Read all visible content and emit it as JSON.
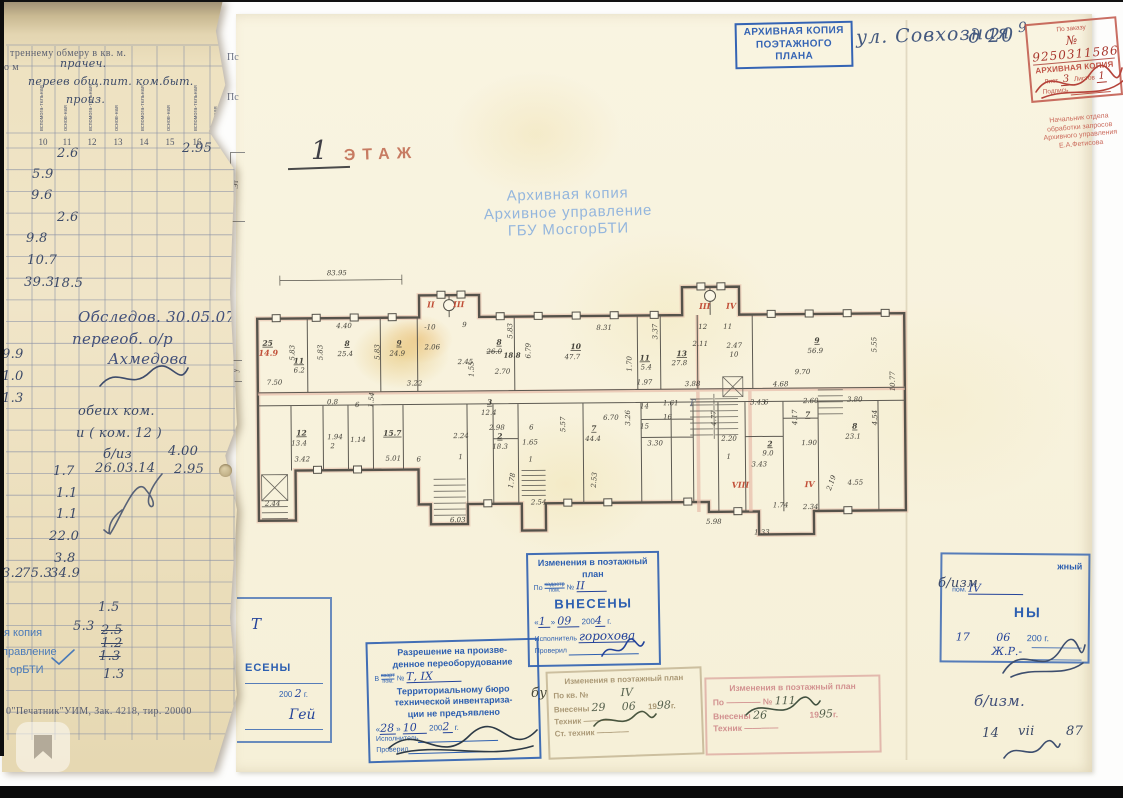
{
  "left_strip": {
    "header": "треннему обмеру в кв. м.",
    "header_left": "о м",
    "hand_over_header": [
      {
        "t": "прачеч.",
        "x": 58,
        "y": 57
      },
      {
        "t": "переев общ.пит. ком.быт.",
        "x": 26,
        "y": 75
      },
      {
        "t": "произ.",
        "x": 64,
        "y": 93
      }
    ],
    "col_headers": [
      {
        "t": "вспомога-тельная",
        "x": 41
      },
      {
        "t": "основ-ная",
        "x": 65
      },
      {
        "t": "вспомога-тельная",
        "x": 90
      },
      {
        "t": "основ-ная",
        "x": 116
      },
      {
        "t": "вспомога-тельная",
        "x": 142
      },
      {
        "t": "основ-ная",
        "x": 168
      },
      {
        "t": "вспомога-тельная",
        "x": 195
      },
      {
        "t": "Полезная",
        "x": 215
      },
      {
        "t": "Высота",
        "x": 226
      }
    ],
    "col_numbers": [
      {
        "t": "10",
        "x": 41
      },
      {
        "t": "11",
        "x": 65
      },
      {
        "t": "12",
        "x": 90
      },
      {
        "t": "13",
        "x": 116
      },
      {
        "t": "14",
        "x": 142
      },
      {
        "t": "15",
        "x": 168
      },
      {
        "t": "16",
        "x": 195
      },
      {
        "t": "17",
        "x": 220
      }
    ],
    "values": [
      {
        "t": "2.6",
        "x": 55,
        "y": 146
      },
      {
        "t": "2.95",
        "x": 180,
        "y": 141
      },
      {
        "t": "5.9",
        "x": 30,
        "y": 167
      },
      {
        "t": "9.6",
        "x": 29,
        "y": 188
      },
      {
        "t": "2.6",
        "x": 55,
        "y": 210
      },
      {
        "t": "9.8",
        "x": 24,
        "y": 231
      },
      {
        "t": "10.7",
        "x": 25,
        "y": 253
      },
      {
        "t": "39.3",
        "x": 22,
        "y": 275
      },
      {
        "t": "18.5",
        "x": 51,
        "y": 276
      },
      {
        "t": "9.9",
        "x": 0,
        "y": 347
      },
      {
        "t": "1.0",
        "x": 0,
        "y": 369
      },
      {
        "t": "1.3",
        "x": 0,
        "y": 391
      },
      {
        "t": "Обследов. 30.05.07",
        "x": 76,
        "y": 308,
        "c": "lg"
      },
      {
        "t": "перееоб. о/р",
        "x": 70,
        "y": 330,
        "c": "lg"
      },
      {
        "t": "Ахмедова",
        "x": 106,
        "y": 350,
        "c": "lg"
      },
      {
        "t": "обеих ком.",
        "x": 76,
        "y": 404
      },
      {
        "t": "и ( ком. 12 )",
        "x": 74,
        "y": 426
      },
      {
        "t": "б/из",
        "x": 101,
        "y": 447
      },
      {
        "t": "4.00",
        "x": 166,
        "y": 444
      },
      {
        "t": "1.7",
        "x": 51,
        "y": 464
      },
      {
        "t": "26.03.14",
        "x": 93,
        "y": 461
      },
      {
        "t": "2.95",
        "x": 172,
        "y": 462
      },
      {
        "t": "1.1",
        "x": 54,
        "y": 486
      },
      {
        "t": "1.1",
        "x": 54,
        "y": 507
      },
      {
        "t": "22.0",
        "x": 47,
        "y": 529
      },
      {
        "t": "3.8",
        "x": 52,
        "y": 551
      },
      {
        "t": "3.2",
        "x": 0,
        "y": 566
      },
      {
        "t": "75.3",
        "x": 20,
        "y": 566
      },
      {
        "t": "34.9",
        "x": 48,
        "y": 566
      },
      {
        "t": "1.5",
        "x": 96,
        "y": 600
      },
      {
        "t": "5.3",
        "x": 71,
        "y": 619
      },
      {
        "t": "2.5",
        "x": 99,
        "y": 623,
        "c": "struck"
      },
      {
        "t": "1.2",
        "x": 99,
        "y": 636,
        "c": "struck"
      },
      {
        "t": "1.3",
        "x": 97,
        "y": 649,
        "c": "struck"
      },
      {
        "t": "1.3",
        "x": 101,
        "y": 667
      }
    ],
    "blue_fragments": [
      {
        "t": "я копия",
        "x": 2,
        "y": 627
      },
      {
        "t": "правление",
        "x": 0,
        "y": 646
      },
      {
        "t": "орБТИ",
        "x": 8,
        "y": 664
      }
    ],
    "footer_print": "0\"Печатник\"УИМ, Зак. 4218, тир. 20000"
  },
  "sheet": {
    "header_stamp": {
      "line1": "АРХИВНАЯ КОПИЯ",
      "line2": "ПОЭТАЖНОГО ПЛАНА"
    },
    "address1": "ул. Совхозная",
    "address2": "д  20",
    "stray9": "9",
    "red_stamp": {
      "order_label": "По заказу",
      "order_no": "№ 9250311586",
      "copy": "АРХИВНАЯ КОПИЯ",
      "sheet_label": "Лист",
      "sheet_no": "3",
      "sheets_label": "Листов",
      "sheets_no": "1",
      "sign_label": "Подпись",
      "officer": [
        "Начальник отдела",
        "обработки запросов",
        "Архивного управления",
        "Е.А.Фетисова"
      ]
    },
    "floor_label": {
      "num": "1",
      "word": "ЭТАЖ"
    },
    "watermark": [
      "Архивная копия",
      "Архивное управление",
      "ГБУ МосгорБТИ"
    ],
    "edge_fragments": {
      "ps1": "Пс",
      "ps2": "Пс",
      "b1": "Эт",
      "b2": "у"
    },
    "plan": {
      "labels": [
        {
          "t": "83.95",
          "x": 75,
          "y": 13
        },
        {
          "t": "25",
          "x": 10,
          "y": 83,
          "c": "rn"
        },
        {
          "t": "4.40",
          "x": 84,
          "y": 66
        },
        {
          "t": "5.83",
          "x": 42,
          "y": 98,
          "r": -90
        },
        {
          "t": "8",
          "x": 92,
          "y": 84,
          "c": "rn"
        },
        {
          "t": "25.4",
          "x": 85,
          "y": 94
        },
        {
          "t": "5.83",
          "x": 70,
          "y": 98,
          "r": -90
        },
        {
          "t": "9",
          "x": 144,
          "y": 84,
          "c": "rn"
        },
        {
          "t": "24.9",
          "x": 137,
          "y": 94
        },
        {
          "t": "5.83",
          "x": 127,
          "y": 98,
          "r": -90
        },
        {
          "t": "-10",
          "x": 172,
          "y": 68
        },
        {
          "t": "2.06",
          "x": 172,
          "y": 88
        },
        {
          "t": "9",
          "x": 210,
          "y": 66
        },
        {
          "t": "2.45",
          "x": 205,
          "y": 103
        },
        {
          "t": "7.50",
          "x": 14,
          "y": 122
        },
        {
          "t": "3.22",
          "x": 154,
          "y": 124
        },
        {
          "t": "8.31",
          "x": 344,
          "y": 70
        },
        {
          "t": "10",
          "x": 318,
          "y": 89,
          "c": "rn"
        },
        {
          "t": "47.7",
          "x": 312,
          "y": 99
        },
        {
          "t": "6.79",
          "x": 278,
          "y": 98,
          "r": -90
        },
        {
          "t": "5.83",
          "x": 260,
          "y": 78,
          "r": -90
        },
        {
          "t": "8",
          "x": 244,
          "y": 84,
          "c": "rn"
        },
        {
          "t": "26.0",
          "x": 234,
          "y": 93,
          "c": "struck"
        },
        {
          "t": "18.8",
          "x": 251,
          "y": 97,
          "c": "bold"
        },
        {
          "t": "2.70",
          "x": 242,
          "y": 113
        },
        {
          "t": "1.55",
          "x": 221,
          "y": 116,
          "r": -90
        },
        {
          "t": "11",
          "x": 387,
          "y": 101,
          "c": "rn"
        },
        {
          "t": "5.4",
          "x": 388,
          "y": 110
        },
        {
          "t": "1.70",
          "x": 379,
          "y": 112,
          "r": -90
        },
        {
          "t": "1.97",
          "x": 384,
          "y": 125
        },
        {
          "t": "13",
          "x": 424,
          "y": 97,
          "c": "rn"
        },
        {
          "t": "27.8",
          "x": 419,
          "y": 106
        },
        {
          "t": "3.37",
          "x": 405,
          "y": 80,
          "r": -90
        },
        {
          "t": "12",
          "x": 446,
          "y": 70
        },
        {
          "t": "11",
          "x": 471,
          "y": 70
        },
        {
          "t": "2.11",
          "x": 440,
          "y": 87
        },
        {
          "t": "2.47",
          "x": 474,
          "y": 89
        },
        {
          "t": "10",
          "x": 477,
          "y": 98
        },
        {
          "t": "3.88",
          "x": 432,
          "y": 127
        },
        {
          "t": "9",
          "x": 562,
          "y": 85,
          "c": "rn"
        },
        {
          "t": "56.9",
          "x": 555,
          "y": 95
        },
        {
          "t": "5.55",
          "x": 624,
          "y": 95,
          "r": -90
        },
        {
          "t": "10.77",
          "x": 642,
          "y": 134,
          "r": -90
        },
        {
          "t": "9.70",
          "x": 542,
          "y": 116
        },
        {
          "t": "4.68",
          "x": 520,
          "y": 128
        },
        {
          "t": "3.43",
          "x": 497,
          "y": 146
        },
        {
          "t": "6",
          "x": 511,
          "y": 146
        },
        {
          "t": "2.60",
          "x": 550,
          "y": 145
        },
        {
          "t": "3.80",
          "x": 594,
          "y": 144
        },
        {
          "t": "8",
          "x": 599,
          "y": 171,
          "c": "rn"
        },
        {
          "t": "23.1",
          "x": 592,
          "y": 181
        },
        {
          "t": "4.54",
          "x": 624,
          "y": 168,
          "r": -90
        },
        {
          "t": "7",
          "x": 552,
          "y": 159,
          "c": "rn"
        },
        {
          "t": "4.17",
          "x": 544,
          "y": 167,
          "r": -90
        },
        {
          "t": "1.90",
          "x": 548,
          "y": 187
        },
        {
          "t": "2",
          "x": 514,
          "y": 188,
          "c": "rn"
        },
        {
          "t": "9.0",
          "x": 509,
          "y": 197
        },
        {
          "t": "3.43",
          "x": 498,
          "y": 208
        },
        {
          "t": "2.20",
          "x": 468,
          "y": 182
        },
        {
          "t": "1",
          "x": 473,
          "y": 200
        },
        {
          "t": "4.77",
          "x": 463,
          "y": 167,
          "r": -90
        },
        {
          "t": "4.55",
          "x": 594,
          "y": 227
        },
        {
          "t": "2.19",
          "x": 577,
          "y": 233,
          "r": -70
        },
        {
          "t": "2.34",
          "x": 549,
          "y": 251
        },
        {
          "t": "1.74",
          "x": 519,
          "y": 249
        },
        {
          "t": "5.98",
          "x": 452,
          "y": 265
        },
        {
          "t": "1.33",
          "x": 500,
          "y": 276
        },
        {
          "t": "14",
          "x": 387,
          "y": 149
        },
        {
          "t": "1.61",
          "x": 410,
          "y": 146
        },
        {
          "t": "16",
          "x": 410,
          "y": 160
        },
        {
          "t": "15",
          "x": 387,
          "y": 169
        },
        {
          "t": "3.30",
          "x": 394,
          "y": 186
        },
        {
          "t": "3.26",
          "x": 377,
          "y": 166,
          "r": -90
        },
        {
          "t": "6.70",
          "x": 350,
          "y": 160
        },
        {
          "t": "7",
          "x": 338,
          "y": 171,
          "c": "rn"
        },
        {
          "t": "44.4",
          "x": 332,
          "y": 181
        },
        {
          "t": "5.57",
          "x": 312,
          "y": 172,
          "r": -90
        },
        {
          "t": "6",
          "x": 276,
          "y": 169
        },
        {
          "t": "3",
          "x": 234,
          "y": 144,
          "c": "rn"
        },
        {
          "t": "12.4",
          "x": 228,
          "y": 154
        },
        {
          "t": "2.98",
          "x": 236,
          "y": 169
        },
        {
          "t": "2",
          "x": 244,
          "y": 178,
          "c": "rn"
        },
        {
          "t": "18.3",
          "x": 239,
          "y": 188
        },
        {
          "t": "1.65",
          "x": 269,
          "y": 184
        },
        {
          "t": "1",
          "x": 275,
          "y": 201
        },
        {
          "t": "2.54",
          "x": 277,
          "y": 244
        },
        {
          "t": "1.78",
          "x": 259,
          "y": 228,
          "r": -80
        },
        {
          "t": "2.53",
          "x": 342,
          "y": 228,
          "r": -85
        },
        {
          "t": "11",
          "x": 41,
          "y": 101,
          "c": "rn"
        },
        {
          "t": "6.2",
          "x": 41,
          "y": 110
        },
        {
          "t": "0.8",
          "x": 74,
          "y": 142
        },
        {
          "t": "6",
          "x": 102,
          "y": 145
        },
        {
          "t": "1.54",
          "x": 120,
          "y": 146,
          "r": -85
        },
        {
          "t": "12",
          "x": 43,
          "y": 173,
          "c": "rn"
        },
        {
          "t": "13.4",
          "x": 38,
          "y": 183
        },
        {
          "t": "3.42",
          "x": 41,
          "y": 199
        },
        {
          "t": "15.7",
          "x": 130,
          "y": 174,
          "c": "rn"
        },
        {
          "t": "1.94",
          "x": 74,
          "y": 177
        },
        {
          "t": "2",
          "x": 77,
          "y": 186
        },
        {
          "t": "1.14",
          "x": 97,
          "y": 180
        },
        {
          "t": "5.01",
          "x": 132,
          "y": 199
        },
        {
          "t": "2.24",
          "x": 200,
          "y": 177
        },
        {
          "t": "1",
          "x": 205,
          "y": 198
        },
        {
          "t": "6",
          "x": 163,
          "y": 200
        },
        {
          "t": "2.44",
          "x": 11,
          "y": 243
        },
        {
          "t": "6.03",
          "x": 196,
          "y": 261
        },
        {
          "t": "Г",
          "x": 437,
          "y": 147,
          "c": "pencil"
        }
      ],
      "red": [
        {
          "t": "14.9",
          "x": 6,
          "y": 93
        },
        {
          "t": "II",
          "x": 175,
          "y": 46
        },
        {
          "t": "III",
          "x": 201,
          "y": 46
        },
        {
          "t": "III",
          "x": 447,
          "y": 50
        },
        {
          "t": "IV",
          "x": 474,
          "y": 50
        },
        {
          "t": "VIII",
          "x": 478,
          "y": 229
        },
        {
          "t": "IV",
          "x": 551,
          "y": 229
        }
      ]
    },
    "stamp_vnesen": {
      "l1": "Изменения в поэтажный",
      "l2": "план",
      "po": "По",
      "frac_top": "кадастр",
      "frac_bot": "пом.",
      "no": "№",
      "no_val": "II",
      "vneseny": "ВНЕСЕНЫ",
      "d": "1",
      "m": "09",
      "y_pre": "200",
      "y_val": "4",
      "g": "г.",
      "exec": "Исполнитель",
      "exec_val": "горохова",
      "check": "Проверил"
    },
    "stamp_razresh": {
      "l1": "Разрешение на произве-",
      "l2": "денное переоборудование",
      "v": "В",
      "frac_top": "кварт",
      "frac_bot": "пом.",
      "no": "№",
      "no_val": "Т, IХ",
      "l3": "Территориальному бюро",
      "l4": "технической инвентариза-",
      "l5": "ции не предъявлено",
      "d": "28",
      "m": "10",
      "y_pre": "200",
      "y_val": "2",
      "g": "г.",
      "exec": "Исполнитель",
      "check": "Проверил"
    },
    "stamp_faded_left": {
      "l1": "Изменения в поэтажный план",
      "po": "По кв. №",
      "no_val": "IV",
      "vn": "Внесены",
      "d": "29",
      "m": "06",
      "y_pre": "19",
      "y_val": "98",
      "g": "г.",
      "tech": "Техник",
      "st": "Ст. техник"
    },
    "stamp_faded_right": {
      "l1": "Изменения в поэтажный план",
      "po": "По",
      "no": "№",
      "no_val": "111",
      "vn": "Внесены",
      "d": "26",
      "y_pre": "19",
      "y_val": "95",
      "g": "г.",
      "tech": "Техник",
      "st": "Ст. техник"
    },
    "stamp_right_partial": {
      "frag1": "жный",
      "pom": "пом.",
      "pom_val": "IV",
      "frag2": "НЫ",
      "d": "17",
      "m": "06",
      "y_pre": "200",
      "g": "г.",
      "note": "б/изм",
      "sig": "Ж.Р.-"
    },
    "stamp_left_partial": {
      "hw_top": "Т",
      "frag1": "ЕСЕНЫ",
      "y_pre": "200",
      "y_val": "2",
      "g": "г.",
      "sig": "Гей"
    },
    "hand_bu": "бу",
    "hand_right_bottom": {
      "l1": "б/изм.",
      "d": "14",
      "m": "vii",
      "y": "87"
    }
  }
}
